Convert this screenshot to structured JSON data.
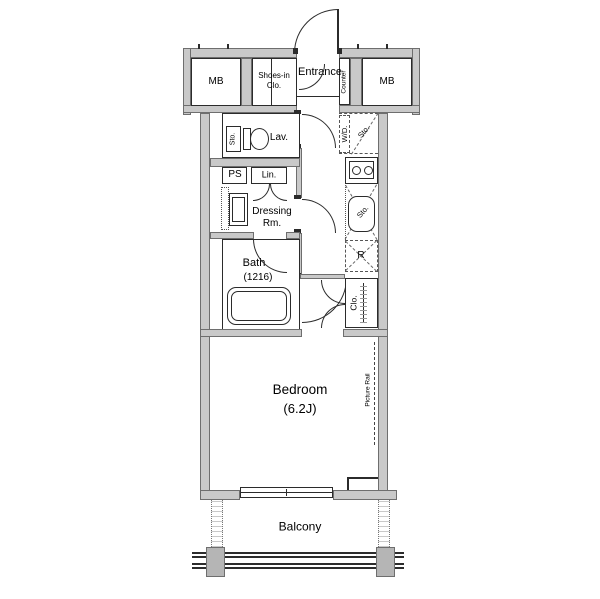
{
  "title": "Studio apartment floor plan",
  "colors": {
    "wall_fill": "#c9c9c9",
    "line": "#2b2b2b",
    "background": "#ffffff"
  },
  "rooms": {
    "mb_left": "MB",
    "mb_right": "MB",
    "shoes_line1": "Shoes-in",
    "shoes_line2": "Clo.",
    "entrance": "Entrance",
    "counter": "Counter",
    "lav": "Lav.",
    "lav_storage": "Sto.",
    "washer_dryer": "W/D.",
    "wd_storage": "Sto.",
    "pipe_space": "PS",
    "linen": "Lin.",
    "dressing_line1": "Dressing",
    "dressing_line2": "Rm.",
    "kitchen_storage": "Sto.",
    "refrigerator": "R",
    "bath_line1": "Bath",
    "bath_line2": "(1216)",
    "closet": "Clo.",
    "bedroom_line1": "Bedroom",
    "bedroom_line2": "(6.2J)",
    "picture_rail": "Picture Rail",
    "balcony": "Balcony"
  }
}
